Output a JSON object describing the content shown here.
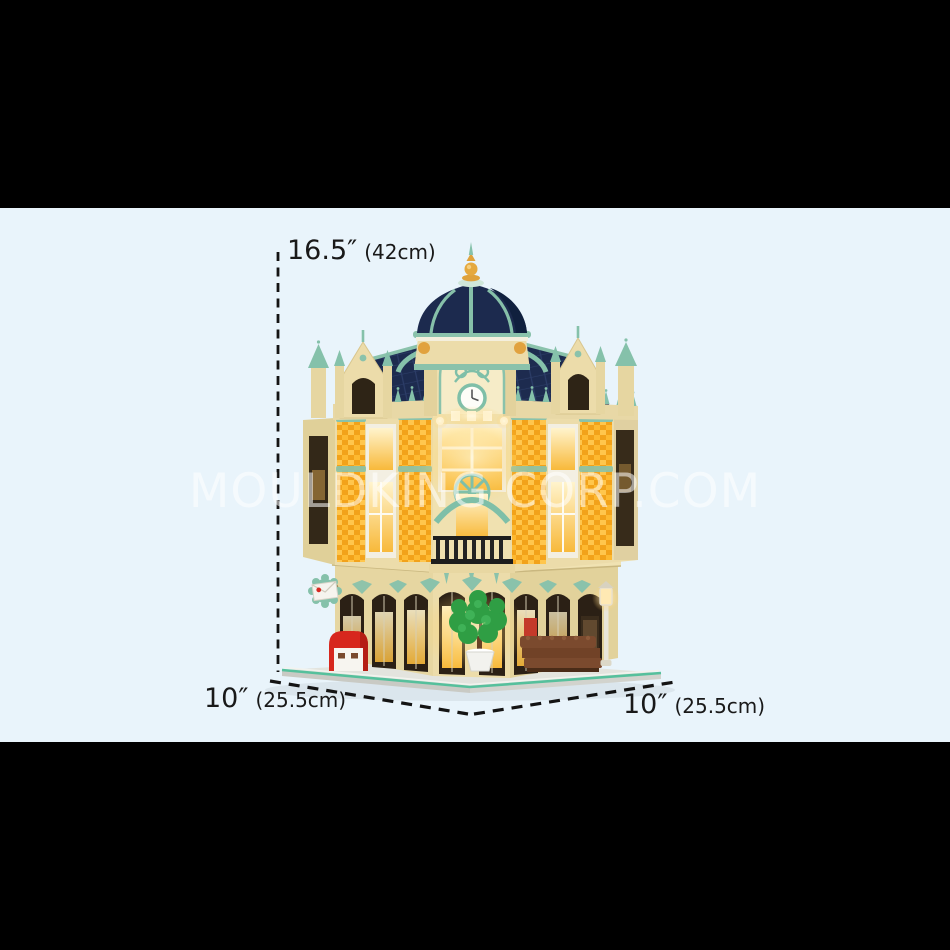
{
  "scene": {
    "watermark_text": "MOULDKING CORP.COM",
    "background_color": "#e9f4fb",
    "letterbox_color": "#000000",
    "subject": "corner post-office brick building model with lights"
  },
  "dimensions": {
    "height": {
      "value": "16.5″",
      "metric": "(42cm)"
    },
    "base_left": {
      "value": "10″",
      "metric": "(25.5cm)"
    },
    "base_right": {
      "value": "10″",
      "metric": "(25.5cm)"
    }
  },
  "palette": {
    "dome_navy": "#1c2a4e",
    "trim_teal": "#85c1aa",
    "wall_cream": "#ecdcaa",
    "brick_amber": "#f2a21a",
    "window_glow": "#ffe8ae",
    "postbox_red": "#d7271d",
    "tree_green": "#2f9e44",
    "bench_brown": "#7b4a2e",
    "baseplate_edge_teal": "#56c09c",
    "label_text": "#191919",
    "watermark_white": "rgba(255,255,255,0.55)"
  }
}
